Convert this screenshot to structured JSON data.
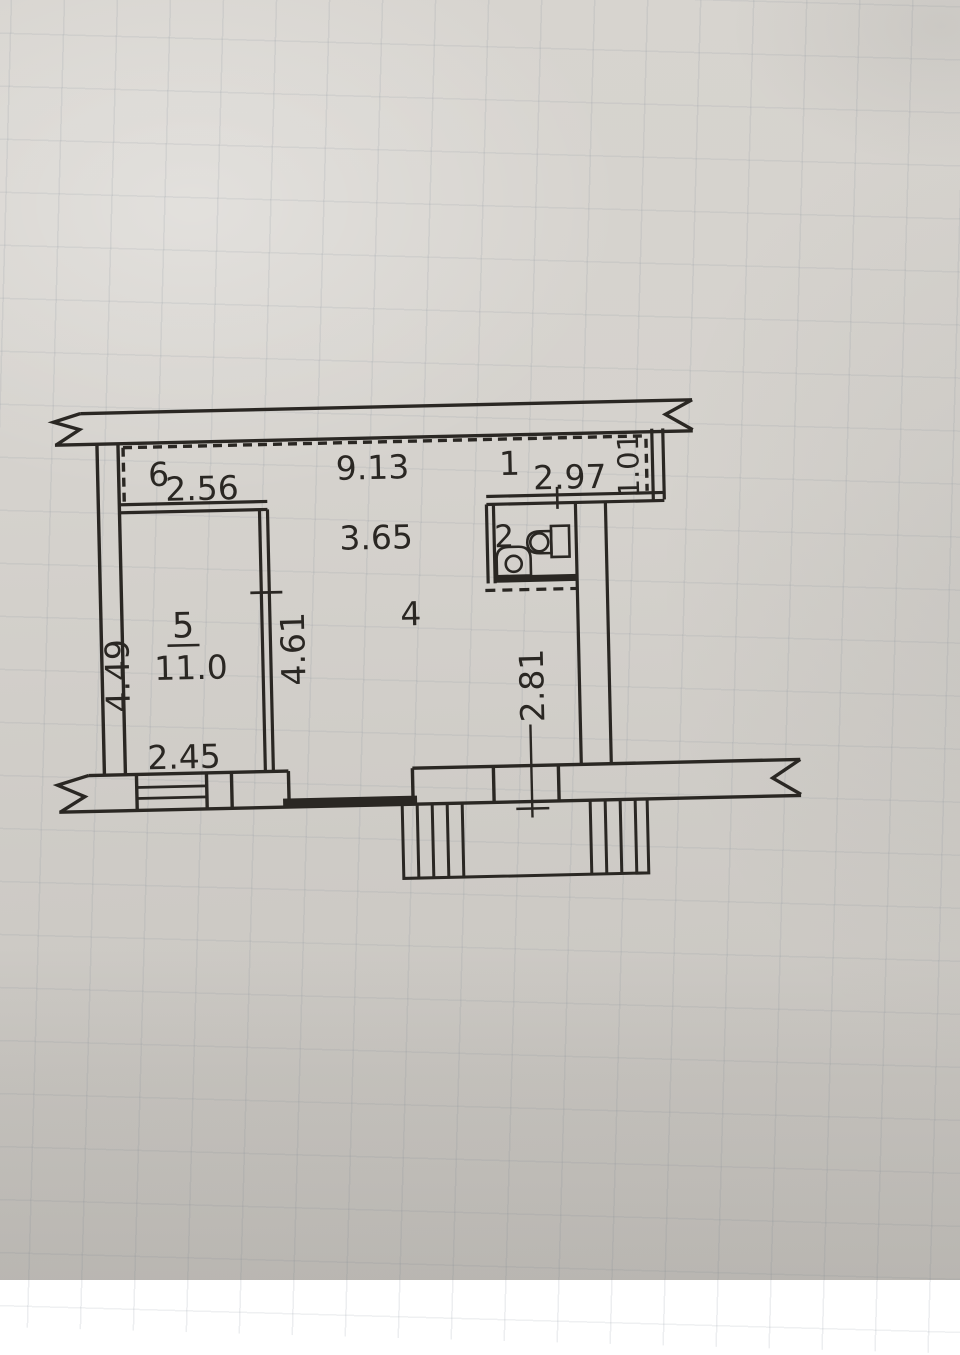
{
  "document": {
    "kind": "apartment floor plan sketch photographed on graph paper"
  },
  "colors": {
    "ink": "#2a2723",
    "paper": "#d5d2cd",
    "grid_line": "#7d8894"
  },
  "rooms": {
    "room1_label": "1",
    "room2_label": "2",
    "room4_label": "4",
    "room5_label": "5",
    "room6_label": "6",
    "room5_area": "11.0"
  },
  "dimensions": {
    "section6_width": "2.56",
    "total_width": "9.13",
    "section1_width": "2.97",
    "section1_depth": "1.01",
    "room4_width": "3.65",
    "room4_depth": "4.61",
    "room5_depth": "4.49",
    "room5_width": "2.45",
    "lower_right_depth": "2.81"
  },
  "icons": {
    "toilet": "toilet-plan-symbol",
    "sink": "sink-plan-symbol"
  }
}
